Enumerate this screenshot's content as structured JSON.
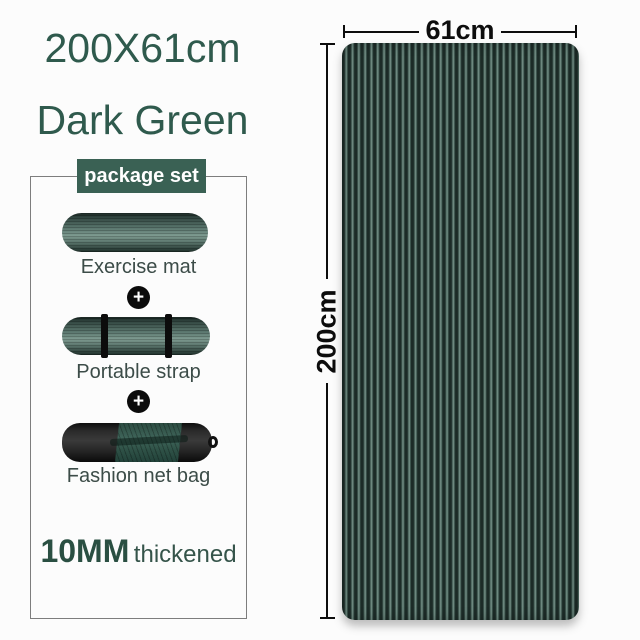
{
  "page": {
    "background": "#fcfcfc",
    "accent_green": "#2f5a4d",
    "label_bg": "#3a6154",
    "mat_stripe_dark": "#1c2b27",
    "mat_stripe_light": "#7a958c"
  },
  "left_panel": {
    "title_line1": "200X61cm",
    "title_line2": "Dark Green",
    "package_label": "package set",
    "plus_symbol": "+",
    "items": [
      {
        "label": "Exercise mat"
      },
      {
        "label": "Portable strap"
      },
      {
        "label": "Fashion net bag"
      }
    ],
    "thickness_value": "10MM",
    "thickness_label": "thickened"
  },
  "mat_preview": {
    "width_label": "61cm",
    "height_label": "200cm"
  }
}
